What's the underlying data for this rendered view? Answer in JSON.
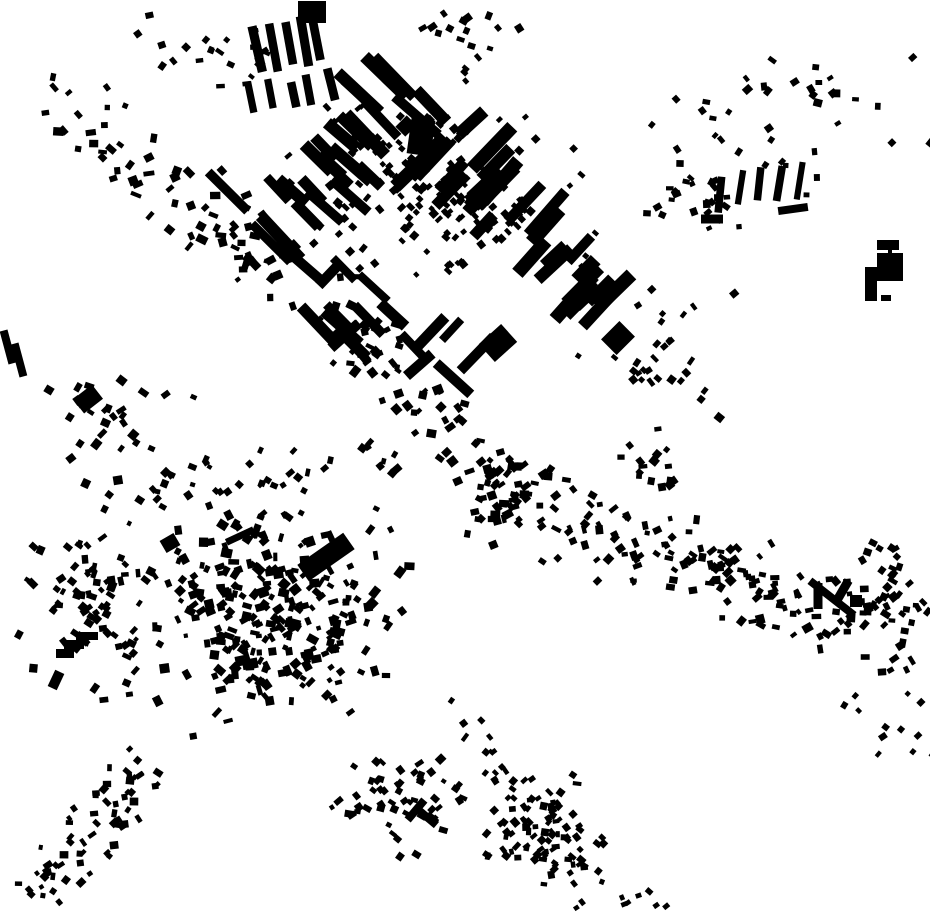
{
  "map": {
    "description": "Black-and-white figure-ground map of building footprints; two diagonal urban corridors crossing near the center, a planned slab-block district in the upper middle, a dense organic old-town cluster in the lower left, scattered hamlets top-right and bottom-right, large empty wedges between corridors",
    "width": 930,
    "height": 924,
    "background_color": "#ffffff",
    "building_color": "#000000",
    "seed": 42,
    "clusters": [
      {
        "name": "nw-arm",
        "kind": "band",
        "x1": 40,
        "y1": 95,
        "x2": 385,
        "y2": 345,
        "width": 100,
        "count": 95,
        "wmin": 5,
        "wmax": 11,
        "hmin": 4,
        "hmax": 9,
        "angles": [
          -45,
          45,
          0,
          20,
          -20
        ],
        "ajit": 18
      },
      {
        "name": "top-left-scatter",
        "kind": "gauss",
        "cx": 215,
        "cy": 55,
        "sx": 75,
        "sy": 40,
        "count": 22,
        "wmin": 5,
        "wmax": 9,
        "hmin": 4,
        "hmax": 8,
        "angles": [
          -40,
          -10,
          30
        ],
        "ajit": 20
      },
      {
        "name": "top-mid-scatter",
        "kind": "gauss",
        "cx": 470,
        "cy": 28,
        "sx": 55,
        "sy": 22,
        "count": 14,
        "wmin": 5,
        "wmax": 9,
        "hmin": 4,
        "hmax": 8,
        "angles": [
          -30,
          20
        ],
        "ajit": 25
      },
      {
        "name": "district-houses",
        "kind": "gauss",
        "cx": 445,
        "cy": 195,
        "sx": 130,
        "sy": 100,
        "count": 150,
        "wmin": 4,
        "wmax": 8,
        "hmin": 4,
        "hmax": 8,
        "angles": [
          45,
          -45
        ],
        "ajit": 12
      },
      {
        "name": "district-dot-row",
        "kind": "band",
        "x1": 335,
        "y1": 120,
        "x2": 520,
        "y2": 225,
        "width": 70,
        "count": 60,
        "wmin": 5,
        "wmax": 8,
        "hmin": 4,
        "hmax": 7,
        "angles": [
          45
        ],
        "ajit": 10
      },
      {
        "name": "district-slabs-a",
        "kind": "band",
        "x1": 255,
        "y1": 235,
        "x2": 420,
        "y2": 75,
        "width": 130,
        "count": 26,
        "wmin": 9,
        "wmax": 14,
        "hmin": 30,
        "hmax": 65,
        "angles": [
          -46
        ],
        "ajit": 7
      },
      {
        "name": "district-slabs-b",
        "kind": "band",
        "x1": 430,
        "y1": 140,
        "x2": 630,
        "y2": 320,
        "width": 150,
        "count": 30,
        "wmin": 9,
        "wmax": 14,
        "hmin": 28,
        "hmax": 60,
        "angles": [
          44
        ],
        "ajit": 7
      },
      {
        "name": "district-slabs-south",
        "kind": "band",
        "x1": 300,
        "y1": 285,
        "x2": 480,
        "y2": 375,
        "width": 90,
        "count": 16,
        "wmin": 8,
        "wmax": 12,
        "hmin": 25,
        "hmax": 50,
        "angles": [
          -45,
          45
        ],
        "ajit": 8
      },
      {
        "name": "top-bars",
        "kind": "row",
        "x1": 256,
        "y1": 52,
        "x2": 318,
        "y2": 40,
        "count": 5,
        "wmin": 8,
        "wmax": 10,
        "hmin": 42,
        "hmax": 52,
        "angles": [
          -12
        ],
        "ajit": 5
      },
      {
        "name": "top-bars-2",
        "kind": "row",
        "x1": 252,
        "y1": 100,
        "x2": 330,
        "y2": 84,
        "count": 5,
        "wmin": 7,
        "wmax": 9,
        "hmin": 24,
        "hmax": 34,
        "angles": [
          -12
        ],
        "ajit": 6
      },
      {
        "name": "top-right-scatter",
        "kind": "gauss",
        "cx": 775,
        "cy": 120,
        "sx": 110,
        "sy": 80,
        "count": 40,
        "wmin": 5,
        "wmax": 9,
        "hmin": 4,
        "hmax": 8,
        "angles": [
          -45,
          45,
          0
        ],
        "ajit": 30
      },
      {
        "name": "tr-bar-group",
        "kind": "row",
        "x1": 722,
        "y1": 192,
        "x2": 802,
        "y2": 180,
        "count": 5,
        "wmin": 6,
        "wmax": 8,
        "hmin": 32,
        "hmax": 40,
        "angles": [
          8
        ],
        "ajit": 5
      },
      {
        "name": "tr-mid-cluster",
        "kind": "gauss",
        "cx": 690,
        "cy": 195,
        "sx": 45,
        "sy": 35,
        "count": 25,
        "wmin": 5,
        "wmax": 9,
        "hmin": 4,
        "hmax": 8,
        "angles": [
          -30,
          30,
          0
        ],
        "ajit": 25
      },
      {
        "name": "left-mid-scatter",
        "kind": "gauss",
        "cx": 105,
        "cy": 415,
        "sx": 65,
        "sy": 38,
        "count": 26,
        "wmin": 5,
        "wmax": 10,
        "hmin": 4,
        "hmax": 9,
        "angles": [
          -45,
          30
        ],
        "ajit": 25
      },
      {
        "name": "junction",
        "kind": "band",
        "x1": 355,
        "y1": 335,
        "x2": 520,
        "y2": 505,
        "width": 75,
        "count": 70,
        "wmin": 5,
        "wmax": 10,
        "hmin": 4,
        "hmax": 9,
        "angles": [
          -45,
          45,
          10,
          -20
        ],
        "ajit": 18
      },
      {
        "name": "east-arm",
        "kind": "band",
        "x1": 480,
        "y1": 490,
        "x2": 920,
        "y2": 640,
        "width": 105,
        "count": 190,
        "wmin": 5,
        "wmax": 10,
        "hmin": 4,
        "hmax": 9,
        "angles": [
          -40,
          40,
          0,
          70
        ],
        "ajit": 25
      },
      {
        "name": "east-subcluster",
        "kind": "gauss",
        "cx": 655,
        "cy": 460,
        "sx": 28,
        "sy": 32,
        "count": 16,
        "wmin": 5,
        "wmax": 9,
        "hmin": 4,
        "hmax": 8,
        "angles": [
          0,
          45
        ],
        "ajit": 20
      },
      {
        "name": "mid-right-scatter",
        "kind": "gauss",
        "cx": 660,
        "cy": 360,
        "sx": 70,
        "sy": 55,
        "count": 30,
        "wmin": 5,
        "wmax": 9,
        "hmin": 4,
        "hmax": 8,
        "angles": [
          -45,
          45
        ],
        "ajit": 25
      },
      {
        "name": "right-edge-cluster",
        "kind": "gauss",
        "cx": 893,
        "cy": 575,
        "sx": 32,
        "sy": 45,
        "count": 22,
        "wmin": 5,
        "wmax": 9,
        "hmin": 4,
        "hmax": 8,
        "angles": [
          -40,
          30
        ],
        "ajit": 25
      },
      {
        "name": "sw-core",
        "kind": "gauss",
        "cx": 270,
        "cy": 615,
        "sx": 115,
        "sy": 92,
        "count": 270,
        "wmin": 4,
        "wmax": 11,
        "hmin": 4,
        "hmax": 10,
        "angles": [
          -45,
          45,
          0,
          20,
          -20,
          70
        ],
        "ajit": 25
      },
      {
        "name": "sw-west",
        "kind": "gauss",
        "cx": 92,
        "cy": 595,
        "sx": 62,
        "sy": 85,
        "count": 85,
        "wmin": 4,
        "wmax": 10,
        "hmin": 4,
        "hmax": 9,
        "angles": [
          -45,
          45,
          0,
          30
        ],
        "ajit": 25
      },
      {
        "name": "sw-north-fringe",
        "kind": "band",
        "x1": 150,
        "y1": 487,
        "x2": 395,
        "y2": 455,
        "width": 55,
        "count": 40,
        "wmin": 4,
        "wmax": 9,
        "hmin": 4,
        "hmax": 8,
        "angles": [
          -45,
          20
        ],
        "ajit": 25
      },
      {
        "name": "sw-trail-bottomleft",
        "kind": "band",
        "x1": 150,
        "y1": 765,
        "x2": 25,
        "y2": 905,
        "width": 75,
        "count": 65,
        "wmin": 4,
        "wmax": 9,
        "hmin": 4,
        "hmax": 8,
        "angles": [
          -45,
          45,
          0
        ],
        "ajit": 25
      },
      {
        "name": "south-center-cluster",
        "kind": "gauss",
        "cx": 400,
        "cy": 800,
        "sx": 52,
        "sy": 45,
        "count": 55,
        "wmin": 4,
        "wmax": 9,
        "hmin": 4,
        "hmax": 8,
        "angles": [
          -45,
          45,
          20
        ],
        "ajit": 25
      },
      {
        "name": "south-right-cluster",
        "kind": "gauss",
        "cx": 545,
        "cy": 835,
        "sx": 58,
        "sy": 52,
        "count": 75,
        "wmin": 4,
        "wmax": 9,
        "hmin": 4,
        "hmax": 8,
        "angles": [
          -45,
          45,
          0
        ],
        "ajit": 25
      },
      {
        "name": "south-trail",
        "kind": "band",
        "x1": 445,
        "y1": 700,
        "x2": 600,
        "y2": 890,
        "width": 70,
        "count": 35,
        "wmin": 4,
        "wmax": 8,
        "hmin": 4,
        "hmax": 7,
        "angles": [
          -45,
          45
        ],
        "ajit": 25
      },
      {
        "name": "bottom-right-sparse",
        "kind": "gauss",
        "cx": 880,
        "cy": 720,
        "sx": 45,
        "sy": 40,
        "count": 12,
        "wmin": 4,
        "wmax": 8,
        "hmin": 4,
        "hmax": 7,
        "angles": [
          -45,
          30
        ],
        "ajit": 25
      },
      {
        "name": "bottom-edge-bits",
        "kind": "gauss",
        "cx": 640,
        "cy": 898,
        "sx": 40,
        "sy": 16,
        "count": 8,
        "wmin": 4,
        "wmax": 7,
        "hmin": 4,
        "hmax": 6,
        "angles": [
          -30,
          30
        ],
        "ajit": 25
      }
    ],
    "landmarks": [
      {
        "shape": "poly",
        "name": "staircase-building",
        "points": "98,632 98,640 84,640 84,649 74,649 74,658 56,658 56,649 64,649 64,640 76,640 76,632"
      },
      {
        "shape": "rect",
        "name": "large-slab-oldtown",
        "cx": 326,
        "cy": 557,
        "w": 56,
        "h": 20,
        "angle": -35
      },
      {
        "shape": "rect",
        "name": "district-large-block",
        "cx": 421,
        "cy": 137,
        "w": 24,
        "h": 36,
        "angle": 8
      },
      {
        "shape": "rect",
        "name": "district-large-block-wing",
        "cx": 406,
        "cy": 126,
        "w": 14,
        "h": 16,
        "angle": 45
      },
      {
        "shape": "rect",
        "name": "district-south-block",
        "cx": 498,
        "cy": 343,
        "w": 30,
        "h": 24,
        "angle": -42
      },
      {
        "shape": "rect",
        "name": "district-south-block-2",
        "cx": 618,
        "cy": 338,
        "w": 26,
        "h": 22,
        "angle": -45
      },
      {
        "shape": "rect",
        "name": "topright-bar",
        "cx": 888,
        "cy": 245,
        "w": 22,
        "h": 10,
        "angle": 0
      },
      {
        "shape": "rect",
        "name": "topright-block",
        "cx": 890,
        "cy": 267,
        "w": 26,
        "h": 28,
        "angle": 0
      },
      {
        "shape": "rect",
        "name": "topright-tower",
        "cx": 871,
        "cy": 284,
        "w": 12,
        "h": 34,
        "angle": 0
      },
      {
        "shape": "rect",
        "name": "topright-dash",
        "cx": 886,
        "cy": 298,
        "w": 10,
        "h": 6,
        "angle": 0
      },
      {
        "shape": "rect",
        "name": "topright-link",
        "cx": 890,
        "cy": 253,
        "w": 4,
        "h": 10,
        "angle": 0
      },
      {
        "shape": "rect",
        "name": "tr-dash-a",
        "cx": 712,
        "cy": 219,
        "w": 22,
        "h": 9,
        "angle": 0
      },
      {
        "shape": "rect",
        "name": "tr-dash-b",
        "cx": 793,
        "cy": 209,
        "w": 30,
        "h": 8,
        "angle": -8
      },
      {
        "shape": "rect",
        "name": "left-edge-bar-a",
        "cx": 8,
        "cy": 347,
        "w": 8,
        "h": 34,
        "angle": -15
      },
      {
        "shape": "rect",
        "name": "left-edge-bar-b",
        "cx": 19,
        "cy": 360,
        "w": 8,
        "h": 34,
        "angle": -15
      },
      {
        "shape": "rect",
        "name": "left-mid-blob",
        "cx": 88,
        "cy": 399,
        "w": 24,
        "h": 18,
        "angle": -38
      },
      {
        "shape": "rect",
        "name": "east-long-slab",
        "cx": 832,
        "cy": 598,
        "w": 56,
        "h": 8,
        "angle": 38
      },
      {
        "shape": "rect",
        "name": "east-bar-a",
        "cx": 818,
        "cy": 596,
        "w": 9,
        "h": 26,
        "angle": 0
      },
      {
        "shape": "rect",
        "name": "east-bar-b",
        "cx": 843,
        "cy": 590,
        "w": 9,
        "h": 22,
        "angle": 30
      },
      {
        "shape": "rect",
        "name": "east-blob",
        "cx": 856,
        "cy": 601,
        "w": 12,
        "h": 12,
        "angle": 0
      },
      {
        "shape": "rect",
        "name": "top-edge-blob",
        "cx": 312,
        "cy": 12,
        "w": 28,
        "h": 22,
        "angle": 0
      },
      {
        "shape": "rect",
        "name": "south-l-bar-a",
        "cx": 416,
        "cy": 810,
        "w": 8,
        "h": 26,
        "angle": 40
      },
      {
        "shape": "rect",
        "name": "south-l-bar-b",
        "cx": 428,
        "cy": 818,
        "w": 22,
        "h": 8,
        "angle": 40
      },
      {
        "shape": "rect",
        "name": "oldtown-hook-a",
        "cx": 240,
        "cy": 536,
        "w": 30,
        "h": 7,
        "angle": -25
      },
      {
        "shape": "rect",
        "name": "oldtown-hook-b",
        "cx": 256,
        "cy": 531,
        "w": 7,
        "h": 14,
        "angle": 20
      },
      {
        "shape": "rect",
        "name": "oldtown-blob",
        "cx": 170,
        "cy": 543,
        "w": 16,
        "h": 14,
        "angle": -30
      },
      {
        "shape": "rect",
        "name": "west-bold-bar",
        "cx": 56,
        "cy": 680,
        "w": 10,
        "h": 18,
        "angle": 25
      }
    ]
  }
}
